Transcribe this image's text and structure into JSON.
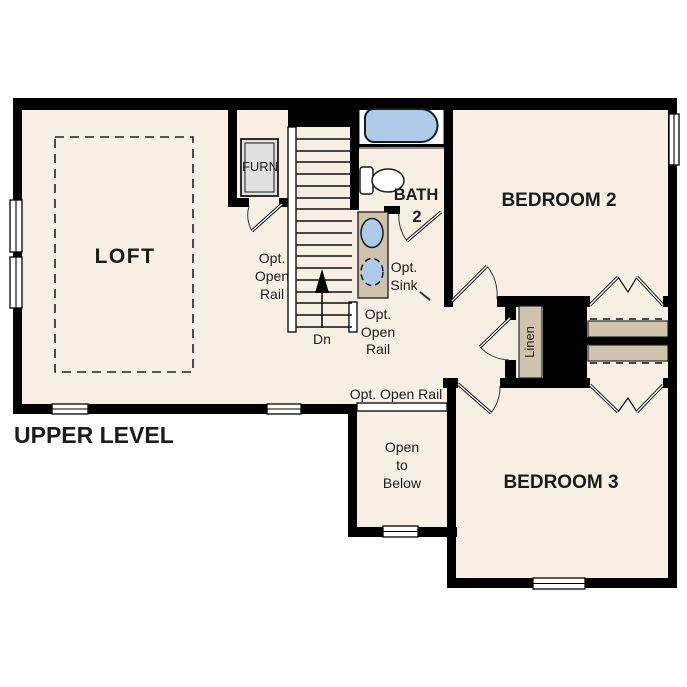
{
  "plan": {
    "title": "UPPER LEVEL",
    "rooms": {
      "loft": "LOFT",
      "bedroom2": "BEDROOM 2",
      "bedroom3": "BEDROOM 3",
      "bath_line1": "BATH",
      "bath_line2": "2"
    },
    "labels": {
      "furnace": "FURN",
      "linen": "Linen",
      "down": "Dn",
      "rail_l1": "Opt.",
      "rail_l2": "Open",
      "rail_l3": "Rail",
      "rail_inline": "Opt. Open Rail",
      "sink_l1": "Opt.",
      "sink_l2": "Sink",
      "open_below_l1": "Open",
      "open_below_l2": "to",
      "open_below_l3": "Below"
    },
    "colors": {
      "floor": "#f7efe4",
      "wall": "#000000",
      "fixture_blue": "#aecbe9",
      "casework_tan": "#cfc3ae",
      "furnace_gray": "#e0e0e0"
    }
  }
}
